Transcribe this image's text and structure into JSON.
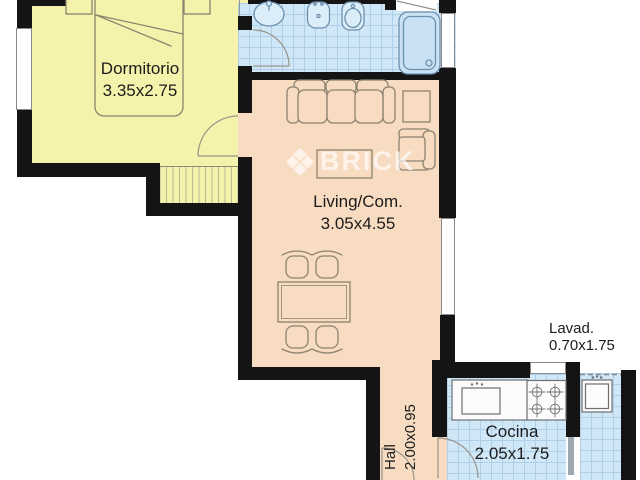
{
  "plan": {
    "watermark": "BRICK",
    "rooms": {
      "dormitorio": {
        "label": "Dormitorio",
        "dims": "3.35x2.75"
      },
      "living": {
        "label": "Living/Com.",
        "dims": "3.05x4.55"
      },
      "cocina": {
        "label": "Cocina",
        "dims": "2.05x1.75"
      },
      "lavadero": {
        "label": "Lavad.",
        "dims": "0.70x1.75"
      },
      "hall": {
        "label": "Hall",
        "dims": "2.00x0.95"
      }
    },
    "colors": {
      "wall": "#141414",
      "bedroom_floor": "#f5f2ac",
      "living_floor": "#f8dcc2",
      "tile_floor": "#d0e7f8",
      "tile_line": "#afcfe8",
      "furniture_outline": "#8c8370",
      "fixture_outline": "#6d90ad",
      "watermark": "rgba(255,255,255,0.65)"
    }
  }
}
